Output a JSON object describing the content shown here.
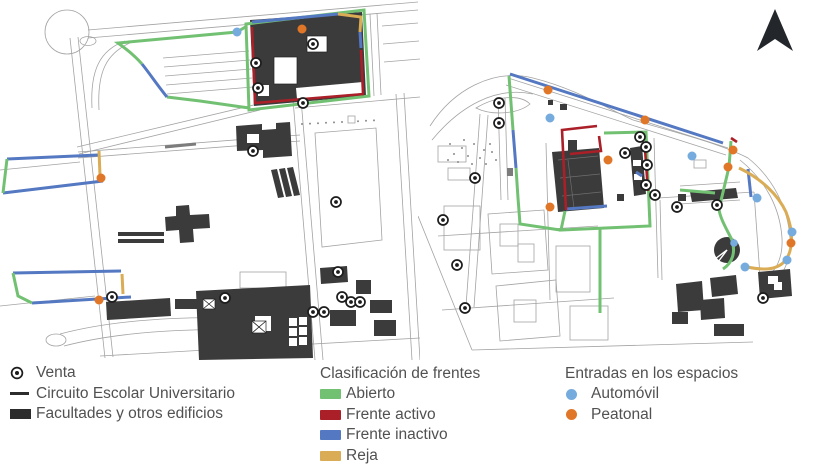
{
  "palette": {
    "abierto_green": "#72c173",
    "activo_red": "#ab1f28",
    "inactivo_blue": "#5478c1",
    "reja_yellow": "#d9ac55",
    "automovil_blue": "#76abdd",
    "peatonal_orange": "#e07728",
    "building_dark": "#3b3b3b",
    "road_gray": "#a3a3a3",
    "text_gray": "#515151"
  },
  "legend": {
    "general": {
      "items": [
        {
          "label": "Venta",
          "icon": "venta-icon"
        },
        {
          "label": "Circuito Escolar Universitario",
          "icon": "line-swatch"
        },
        {
          "label": "Facultades y otros edificios",
          "icon": "building-swatch"
        }
      ]
    },
    "frentes": {
      "title": "Clasificación de frentes",
      "items": [
        {
          "label": "Abierto",
          "color": "#72c173"
        },
        {
          "label": "Frente activo",
          "color": "#ab1f28"
        },
        {
          "label": "Frente inactivo",
          "color": "#5478c1"
        },
        {
          "label": "Reja",
          "color": "#d9ac55"
        }
      ]
    },
    "entradas": {
      "title": "Entradas en los espacios",
      "items": [
        {
          "label": "Automóvil",
          "color": "#76abdd"
        },
        {
          "label": "Peatonal",
          "color": "#e07728"
        }
      ]
    }
  }
}
